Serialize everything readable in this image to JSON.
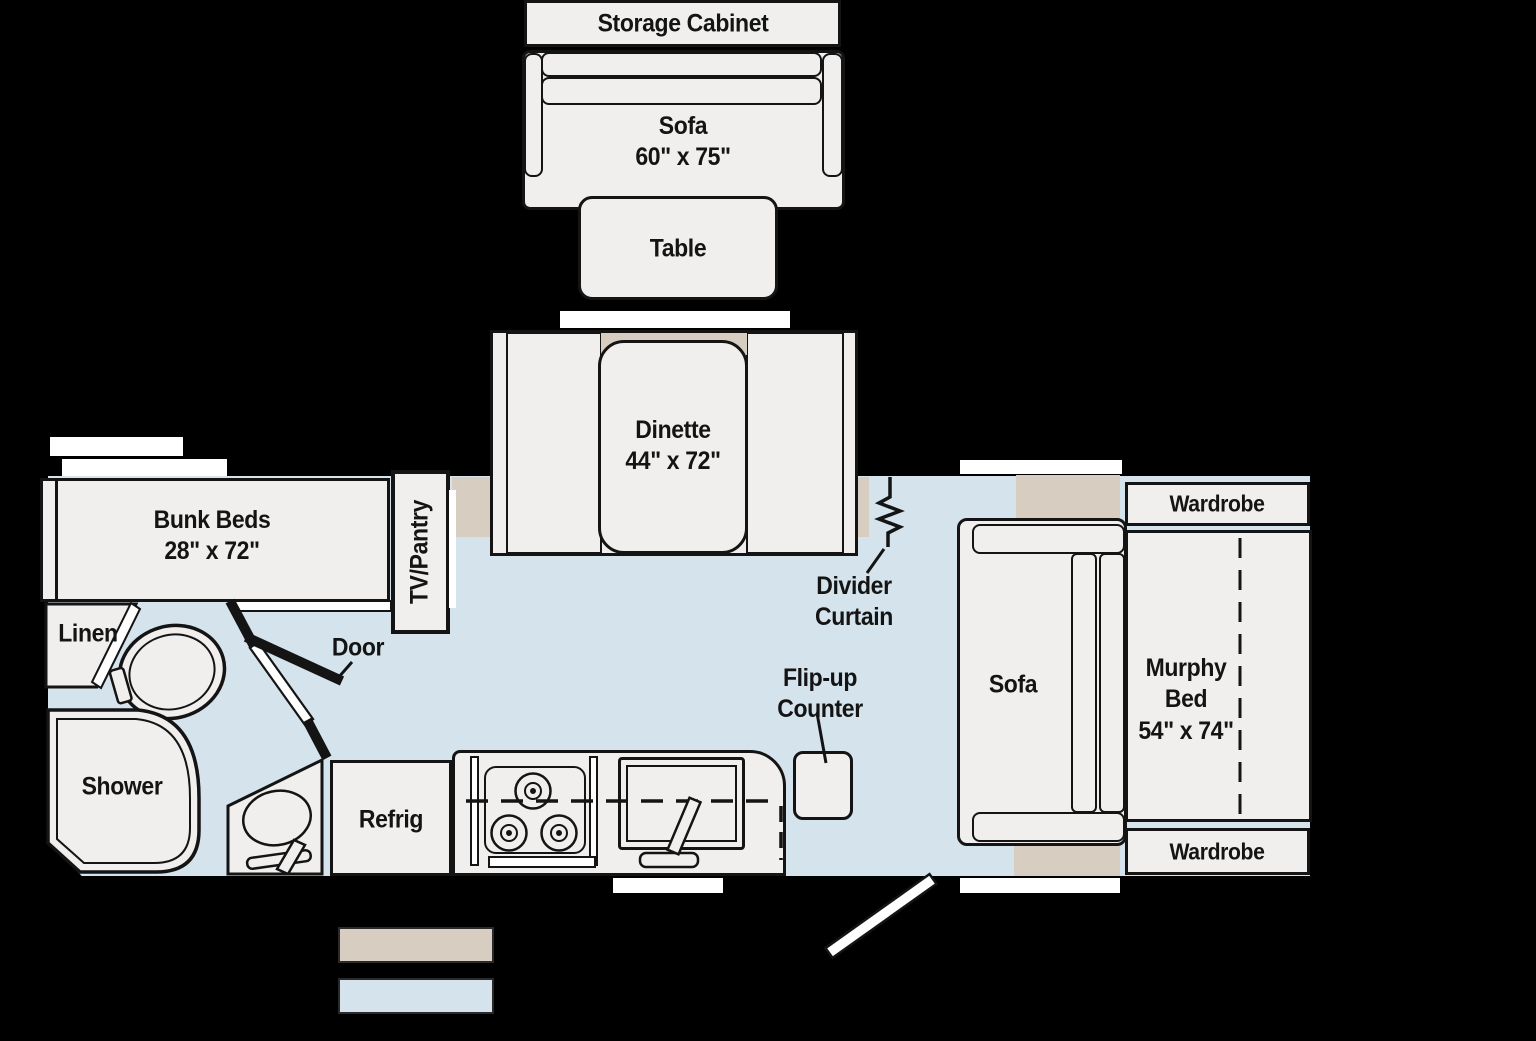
{
  "title": "Travel trailer floor plan",
  "labels": {
    "storage_cabinet": "Storage Cabinet",
    "sofa_top": {
      "name": "Sofa",
      "dims": "60\" x 75\""
    },
    "table": "Table",
    "dinette": {
      "name": "Dinette",
      "dims": "44\" x 72\""
    },
    "bunk_beds": {
      "name": "Bunk Beds",
      "dims": "28\" x 72\""
    },
    "tv_pantry": "TV/Pantry",
    "linen": "Linen",
    "shower": "Shower",
    "door": "Door",
    "refrig": "Refrig",
    "divider_curtain": {
      "line1": "Divider",
      "line2": "Curtain"
    },
    "flip_up_counter": {
      "line1": "Flip-up",
      "line2": "Counter"
    },
    "sofa_right": "Sofa",
    "murphy_bed": {
      "line1": "Murphy",
      "line2": "Bed",
      "dims": "54\" x 74\""
    },
    "wardrobe_top": "Wardrobe",
    "wardrobe_bottom": "Wardrobe"
  },
  "colors": {
    "background": "#000000",
    "furniture": "#f0efed",
    "outline": "#141414",
    "floor": "#d4e3ec",
    "slide_marker": "#d7cdc1",
    "window": "#ffffff"
  },
  "legend": {
    "slide_color": "#d7cdc1",
    "floor_color": "#d4e3ec"
  }
}
